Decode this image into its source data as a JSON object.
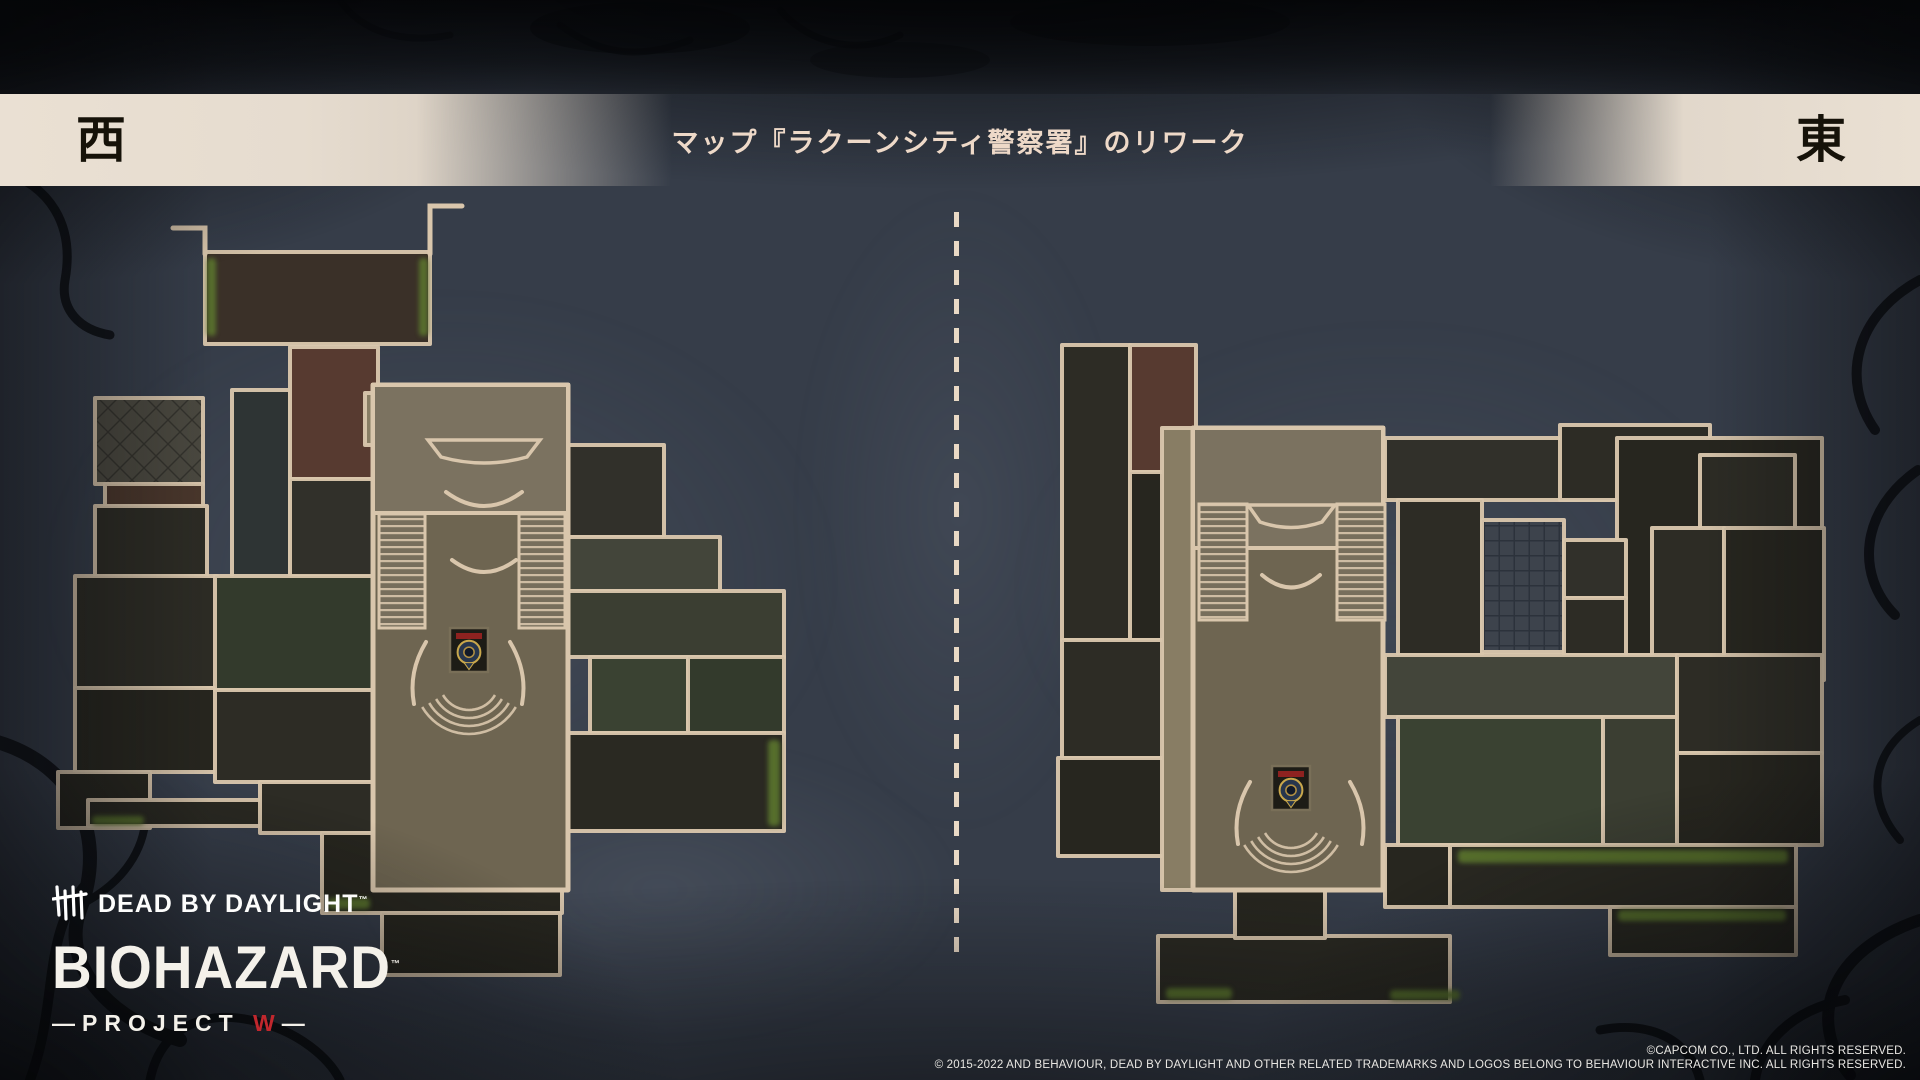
{
  "header": {
    "left_label": "西",
    "right_label": "東",
    "title": "マップ『ラクーンシティ警察署』のリワーク",
    "band_color": "#e7ddd0",
    "title_color": "#eed9c8",
    "label_color": "#161209"
  },
  "divider": {
    "style": "dashed-vertical",
    "color": "#e9d9c5"
  },
  "logo": {
    "dbd_text": "DEAD BY DAYLIGHT",
    "dbd_tm": "™",
    "biohazard_text": "BIOHAZARD",
    "biohazard_tm": "™",
    "project_prefix": "—",
    "project_text": "PROJECT ",
    "project_w": "W",
    "project_suffix": "—",
    "w_color": "#c1272d",
    "hooks_icon": "dbd-hooks-icon"
  },
  "footer": {
    "line1": "©CAPCOM CO., LTD. ALL RIGHTS RESERVED.",
    "line2": "© 2015-2022 AND BEHAVIOUR, DEAD BY DAYLIGHT AND OTHER RELATED TRADEMARKS AND LOGOS BELONG TO BEHAVIOUR INTERACTIVE INC. ALL RIGHTS RESERVED."
  },
  "palette": {
    "wall": "#d9c6ac",
    "dark1": "#2d2c25",
    "dark2": "#27261f",
    "dark3": "#31302a",
    "soil": "#3a3028",
    "brick": "#573a30",
    "brickFloor": "#4a372c",
    "teal": "#2e3434",
    "hallMain": "#6e6551",
    "hallTop": "#7b7260",
    "tan": "#887d64",
    "olive": "#43453a",
    "green1": "#3a4232",
    "green2": "#333a2c",
    "corr": "#3b3e32",
    "tail": "#2a2922",
    "moss": "#5b752f",
    "emblemBg": "#1d1c16",
    "emblemRing": "#c9a84c",
    "emblemBlue": "#27364d",
    "emblemRed": "#8e2220",
    "background": "#363d49"
  },
  "maps": {
    "west": {
      "name": "raccoon-city-police-station-west",
      "rooms": [
        [
          205,
          252,
          225,
          92,
          "soil"
        ],
        [
          232,
          390,
          58,
          190,
          "teal"
        ],
        [
          290,
          347,
          88,
          132,
          "brick"
        ],
        [
          290,
          479,
          88,
          98,
          "dark3"
        ],
        [
          95,
          398,
          108,
          86,
          "checker"
        ],
        [
          105,
          484,
          98,
          22,
          "brickFloor"
        ],
        [
          95,
          506,
          112,
          70,
          "dark1"
        ],
        [
          75,
          576,
          142,
          112,
          "dark1"
        ],
        [
          75,
          688,
          142,
          84,
          "dark2"
        ],
        [
          58,
          772,
          92,
          56,
          "dark2"
        ],
        [
          215,
          576,
          158,
          114,
          "green2"
        ],
        [
          215,
          690,
          158,
          92,
          "dark1"
        ],
        [
          88,
          800,
          272,
          26,
          "tail"
        ],
        [
          260,
          782,
          113,
          51,
          "dark1"
        ],
        [
          365,
          393,
          58,
          52,
          "tan"
        ],
        [
          568,
          445,
          96,
          92,
          "dark3"
        ],
        [
          568,
          537,
          152,
          54,
          "olive"
        ],
        [
          568,
          591,
          216,
          66,
          "corr"
        ],
        [
          590,
          657,
          98,
          76,
          "green1"
        ],
        [
          688,
          657,
          96,
          76,
          "green2"
        ],
        [
          490,
          733,
          294,
          98,
          "tail"
        ],
        [
          322,
          833,
          240,
          80,
          "dark2"
        ],
        [
          382,
          913,
          178,
          62,
          "dark2"
        ]
      ],
      "hall": {
        "outer": [
          373,
          385,
          195,
          505
        ],
        "top": [
          373,
          385,
          195,
          128
        ],
        "stairs": [
          [
            379,
            514,
            46,
            114
          ],
          [
            519,
            514,
            46,
            114
          ]
        ]
      },
      "polys": [
        {
          "d": "M428,440 L540,440 L527,457 Q484,469 441,457 Z",
          "fill": "hallTop"
        }
      ],
      "curves": [
        "M446,492 Q484,520 522,492",
        "M452,560 Q484,584 516,560",
        "M426,642 Q408,672 414,704",
        "M510,642 Q528,672 522,704"
      ],
      "walls": [
        "M205,254 L205,228 L173,228",
        "M430,254 L430,206 L462,206"
      ],
      "emblem": {
        "x": 450,
        "y": 628,
        "w": 38,
        "h": 44
      },
      "arcs": {
        "cx": 469,
        "cy": 680,
        "radii": [
          30,
          38,
          46,
          54
        ],
        "a0": 30,
        "a1": 150
      },
      "moss": [
        [
          207,
          258,
          9,
          78
        ],
        [
          419,
          258,
          9,
          78
        ],
        [
          92,
          816,
          52,
          9
        ],
        [
          328,
          898,
          42,
          11
        ],
        [
          768,
          740,
          12,
          86
        ]
      ]
    },
    "east": {
      "name": "raccoon-city-police-station-east",
      "rooms": [
        [
          1062,
          345,
          68,
          295,
          "dark1"
        ],
        [
          1130,
          345,
          66,
          127,
          "brick"
        ],
        [
          1130,
          472,
          66,
          168,
          "dark2"
        ],
        [
          1062,
          640,
          134,
          118,
          "dark1"
        ],
        [
          1058,
          758,
          138,
          98,
          "dark2"
        ],
        [
          1162,
          428,
          33,
          462,
          "tan"
        ],
        [
          1385,
          438,
          232,
          62,
          "dark3"
        ],
        [
          1560,
          425,
          150,
          75,
          "dark1"
        ],
        [
          1617,
          438,
          205,
          217,
          "dark2"
        ],
        [
          1700,
          455,
          95,
          95,
          "dark1"
        ],
        [
          1398,
          500,
          84,
          155,
          "dark1"
        ],
        [
          1482,
          520,
          82,
          132,
          "tiles"
        ],
        [
          1564,
          540,
          62,
          58,
          "dark3"
        ],
        [
          1564,
          598,
          62,
          57,
          "dark1"
        ],
        [
          1652,
          528,
          72,
          152,
          "dark1"
        ],
        [
          1724,
          528,
          100,
          152,
          "dark2"
        ],
        [
          1385,
          655,
          292,
          62,
          "olive"
        ],
        [
          1398,
          717,
          205,
          128,
          "green1"
        ],
        [
          1603,
          717,
          74,
          128,
          "corr"
        ],
        [
          1677,
          655,
          145,
          98,
          "dark1"
        ],
        [
          1677,
          753,
          145,
          92,
          "dark2"
        ],
        [
          1385,
          845,
          65,
          62,
          "dark2"
        ],
        [
          1450,
          845,
          346,
          62,
          "tail"
        ],
        [
          1610,
          907,
          186,
          48,
          "tail"
        ],
        [
          1158,
          936,
          292,
          66,
          "tail"
        ],
        [
          1235,
          890,
          90,
          48,
          "dark2"
        ]
      ],
      "hall": {
        "outer": [
          1193,
          428,
          190,
          462
        ],
        "top": [
          1193,
          428,
          190,
          120
        ],
        "stairs": [
          [
            1199,
            504,
            48,
            116
          ],
          [
            1337,
            504,
            48,
            116
          ]
        ]
      },
      "polys": [
        {
          "d": "M1248,505 L1335,505 L1322,522 Q1291,533 1260,522 Z",
          "fill": "hallTop"
        }
      ],
      "curves": [
        "M1262,575 Q1291,600 1320,575",
        "M1250,782 Q1232,812 1238,844",
        "M1350,782 Q1368,812 1362,844"
      ],
      "walls": [],
      "emblem": {
        "x": 1272,
        "y": 766,
        "w": 38,
        "h": 44
      },
      "arcs": {
        "cx": 1291,
        "cy": 818,
        "radii": [
          30,
          38,
          46,
          54
        ],
        "a0": 30,
        "a1": 150
      },
      "moss": [
        [
          1458,
          850,
          330,
          13
        ],
        [
          1618,
          910,
          168,
          11
        ],
        [
          1166,
          988,
          66,
          11
        ],
        [
          1390,
          990,
          70,
          10
        ]
      ]
    }
  }
}
